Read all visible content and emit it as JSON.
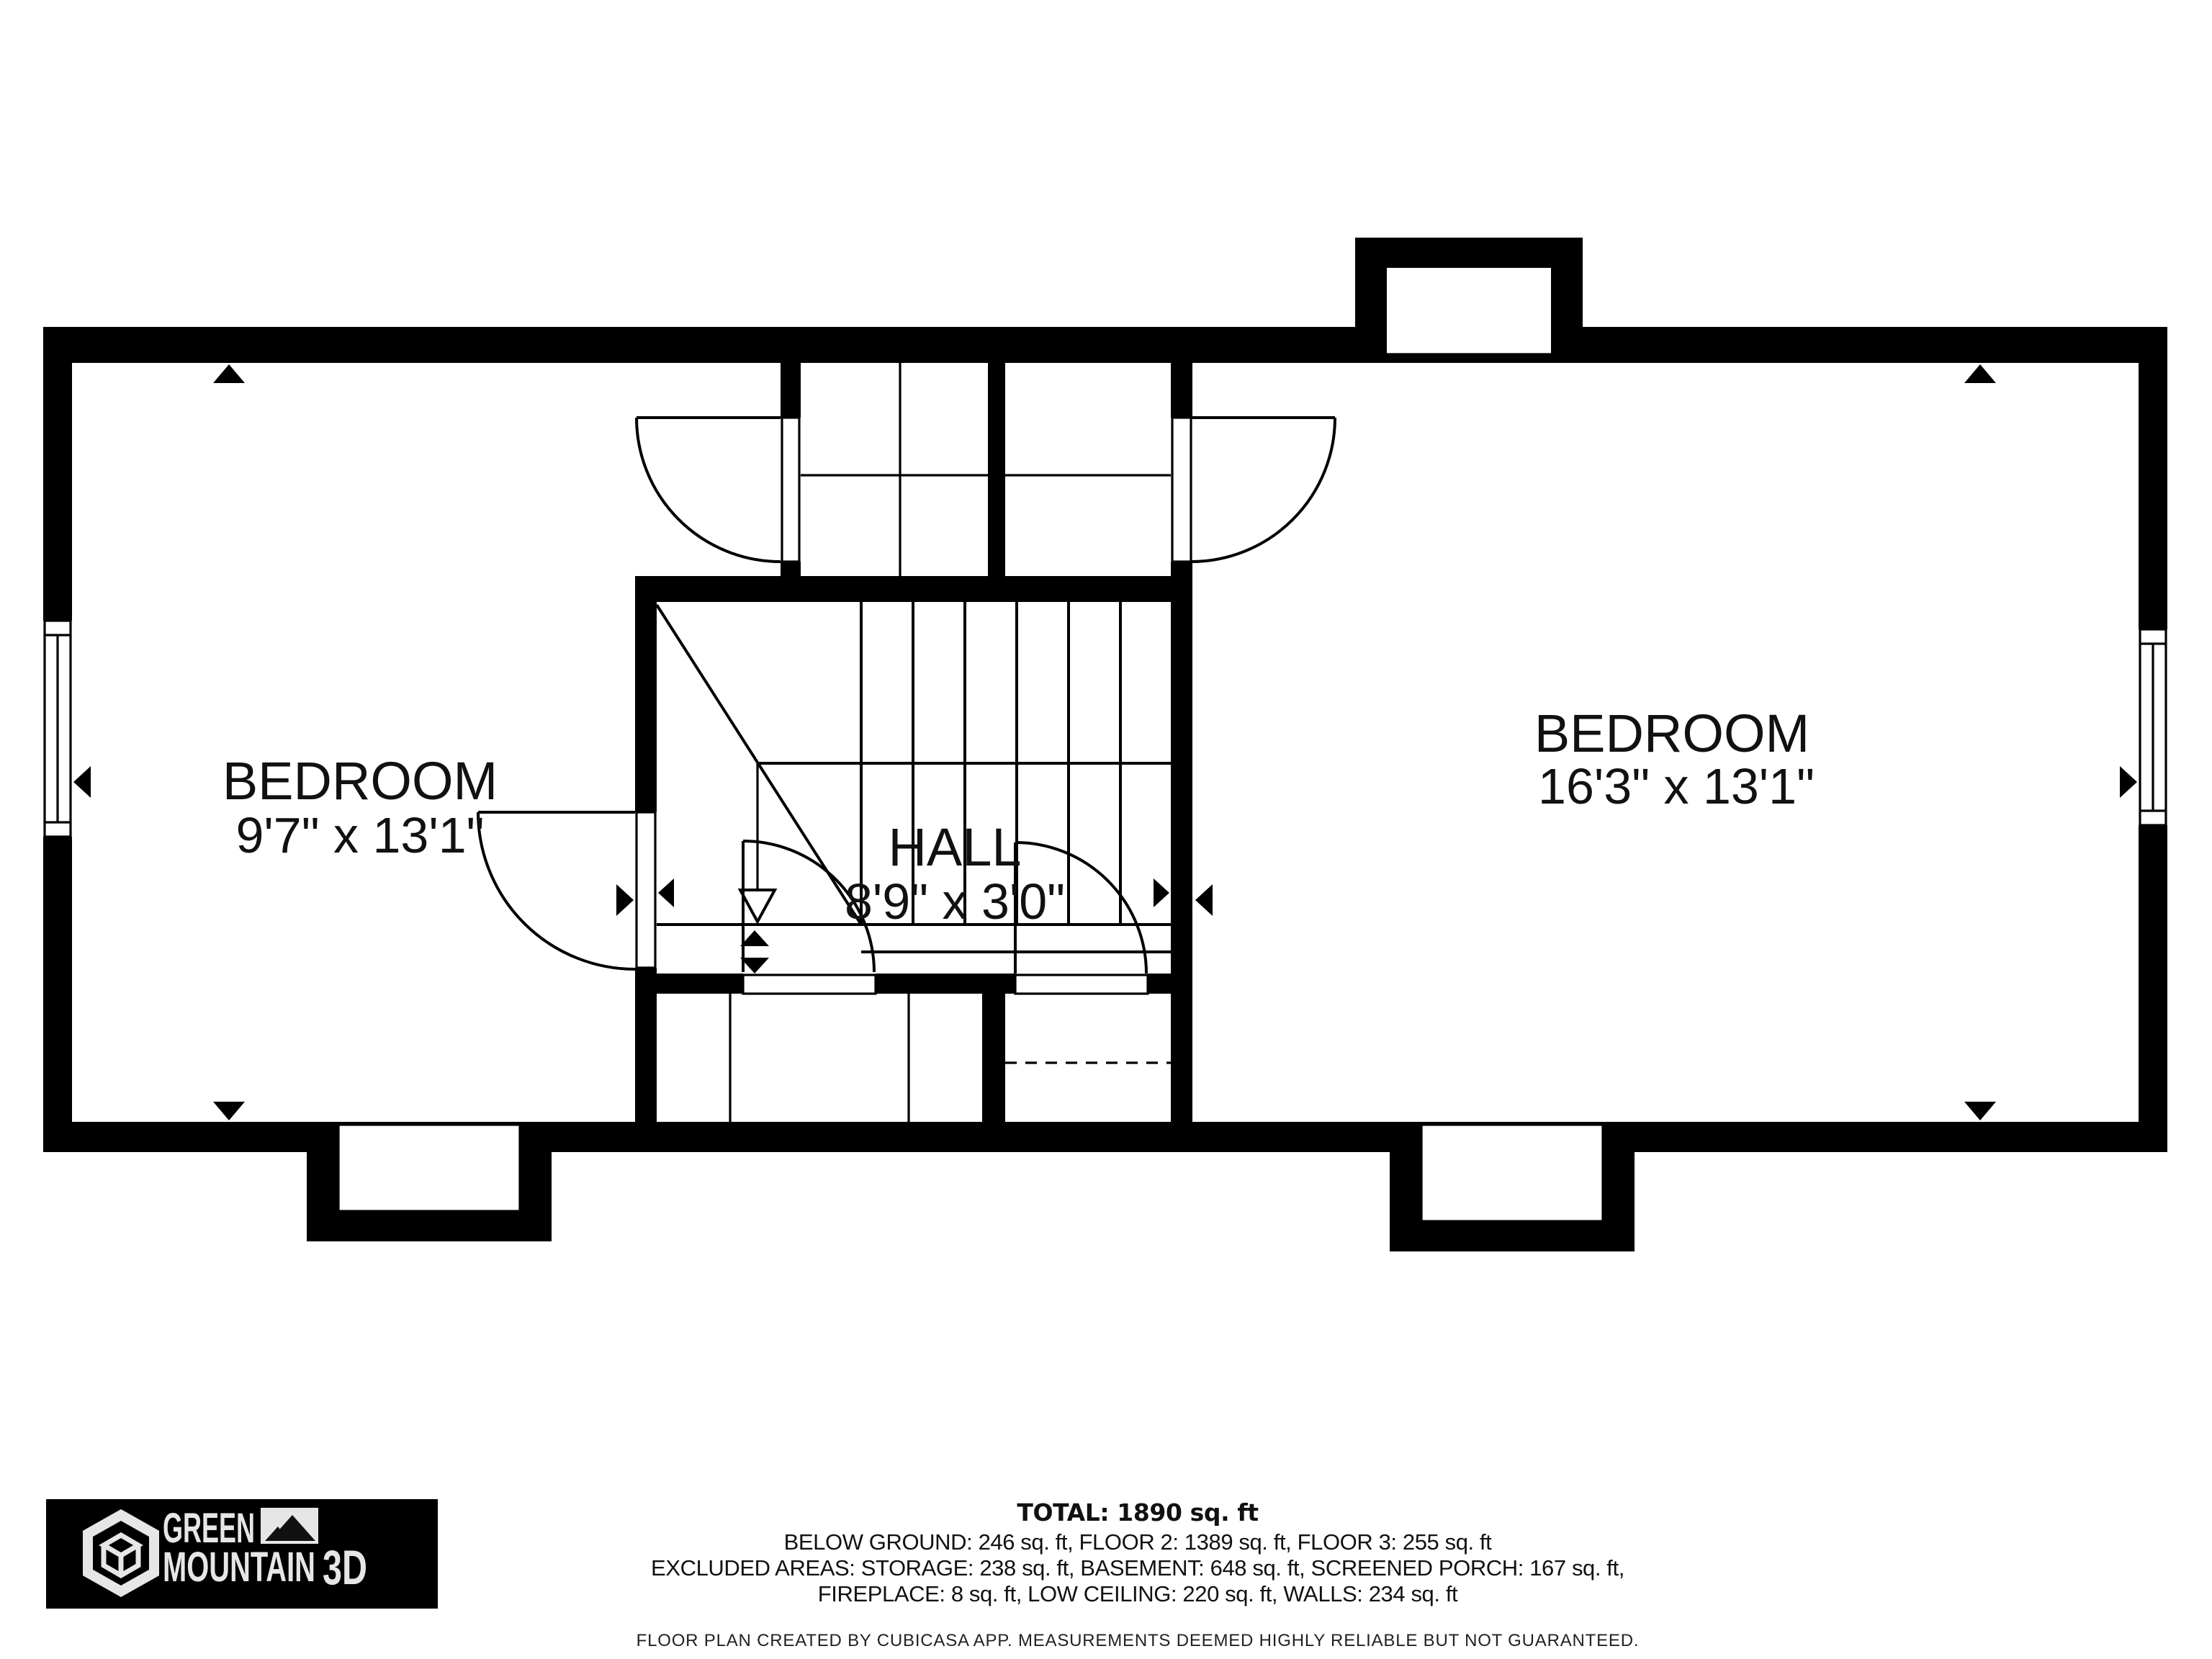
{
  "rooms": {
    "bedroom_left": {
      "name": "BEDROOM",
      "dims": "9'7\" x 13'1\""
    },
    "bedroom_right": {
      "name": "BEDROOM",
      "dims": "16'3\" x 13'1\""
    },
    "hall": {
      "name": "HALL",
      "dims": "8'9\" x 3'0\""
    }
  },
  "summary": {
    "total": "TOTAL: 1890 sq. ft",
    "floors": "BELOW GROUND: 246 sq. ft, FLOOR 2: 1389 sq. ft, FLOOR 3: 255 sq. ft",
    "excluded_1": "EXCLUDED AREAS: STORAGE: 238 sq. ft, BASEMENT: 648 sq. ft, SCREENED PORCH: 167 sq. ft,",
    "excluded_2": "FIREPLACE: 8 sq. ft, LOW CEILING: 220 sq. ft, WALLS: 234 sq. ft",
    "disclaimer": "FLOOR PLAN CREATED BY CUBICASA APP. MEASUREMENTS DEEMED HIGHLY RELIABLE BUT NOT GUARANTEED."
  },
  "logo": {
    "word1": "GREEN",
    "word2": "MOUNTAIN",
    "word3": "3D"
  },
  "colors": {
    "wall": "#000000",
    "bg": "#ffffff",
    "logo_bg": "#000000",
    "logo_fg": "#e6e6e6"
  }
}
